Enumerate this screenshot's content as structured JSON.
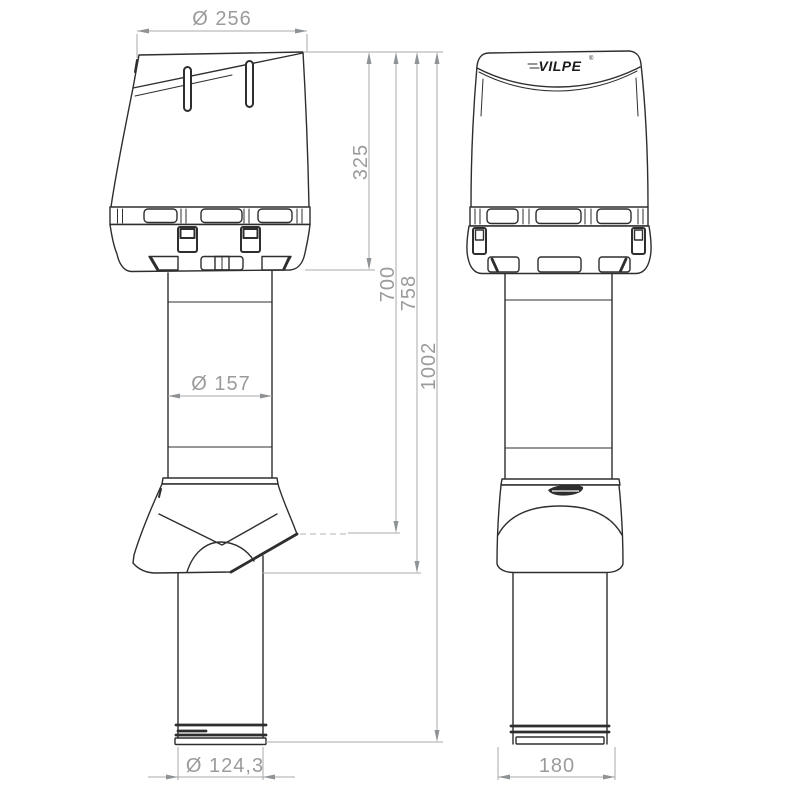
{
  "drawing": {
    "brand": {
      "logo_text": "VILPE",
      "registered_mark": "®"
    },
    "colors": {
      "background": "#ffffff",
      "part_line": "#2e2e2e",
      "dimension_line": "#a8a8a8",
      "dimension_text": "#9b9b9b",
      "logo_text": "#1c1c1c"
    },
    "dimensions": {
      "cap_diameter": "Ø 256",
      "cap_height": "325",
      "height_to_roof": "700",
      "flashing_height": "758",
      "total_height": "1002",
      "pipe_diameter": "Ø 157",
      "bottom_pipe_diameter": "Ø 124,3",
      "bottom_width": "180"
    }
  }
}
